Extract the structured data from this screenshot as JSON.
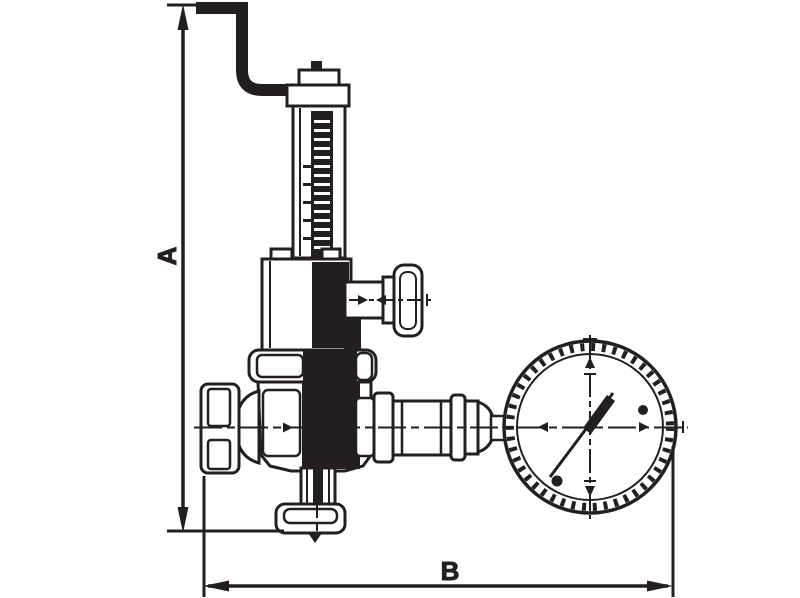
{
  "drawing": {
    "labels": {
      "height_dimension": "A",
      "width_dimension": "B"
    },
    "colors": {
      "ink": "#231f20",
      "paper": "#ffffff"
    },
    "components": [
      "lever-handle",
      "spindle-cap",
      "spindle-tube",
      "spring-housing",
      "side-tee",
      "adjustment-handwheel",
      "top-flange",
      "valve-body",
      "inlet-union-nut",
      "outlet-union",
      "gauge-connector-pipe",
      "pressure-gauge",
      "gauge-needle",
      "bottom-flange"
    ]
  }
}
